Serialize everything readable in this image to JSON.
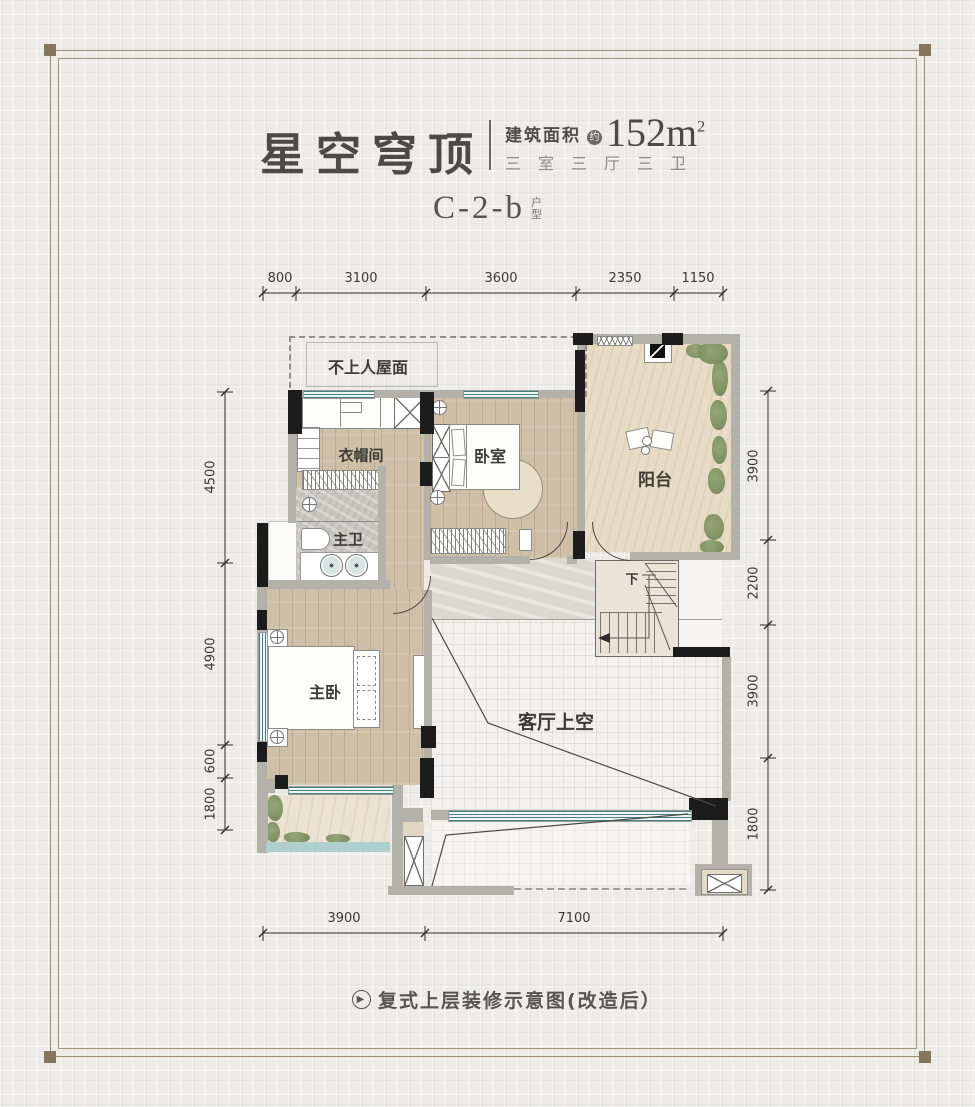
{
  "header": {
    "title": "星空穹顶",
    "area_label": "建筑面积",
    "area_approx": "约",
    "area_value": "152m",
    "area_sup": "2",
    "spec": "三室三厅三卫",
    "unit_code": "C-2-b",
    "unit_label": "户型"
  },
  "rooms": {
    "roof": "不上人屋面",
    "cloak": "衣帽间",
    "bedroom": "卧室",
    "balcony": "阳台",
    "master_bath": "主卫",
    "master_bed": "主卧",
    "living_void": "客厅上空",
    "stairs_down": "下"
  },
  "dims": {
    "top": [
      "800",
      "3100",
      "3600",
      "2350",
      "1150"
    ],
    "left": [
      "4500",
      "4900",
      "600",
      "1800"
    ],
    "right": [
      "3900",
      "2200",
      "3900",
      "1800"
    ],
    "bottom": [
      "3900",
      "7100"
    ]
  },
  "caption": {
    "icon": "▶",
    "text": "复式上层装修示意图(改造后）"
  },
  "colors": {
    "frame": "#9c8c75",
    "wall_gray": "#b4b1ab",
    "column_black": "#1c1c1c",
    "window_teal": "#46807f",
    "wood": "#cfbfa7",
    "balcony_floor": "#e9dcc6",
    "void_tile": "#f2f1ed",
    "plant_green": "#7c9060",
    "text_dark": "#3c3b38"
  }
}
